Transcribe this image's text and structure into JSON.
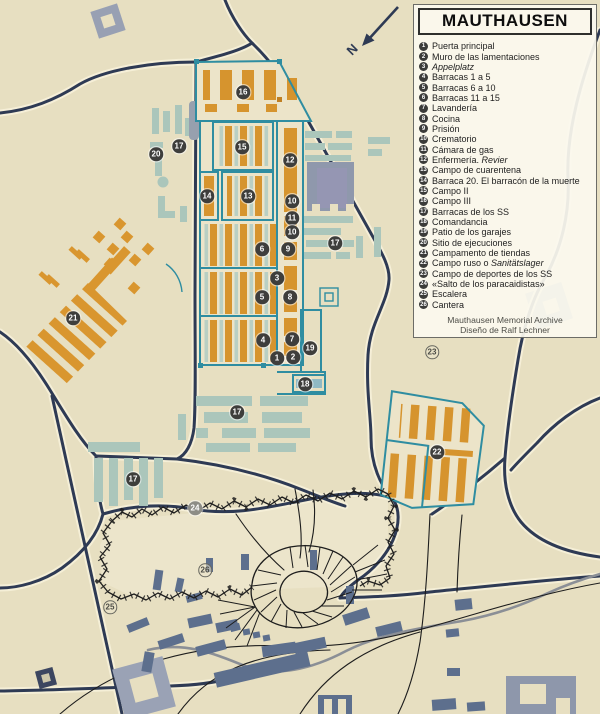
{
  "map": {
    "north_label": "N",
    "colors": {
      "background": "#e7dfc1",
      "road": "#2e3a54",
      "camp_outline": "#2f8da1",
      "barracks_orange": "#d6942e",
      "building_teal": "#abc6bb",
      "building_gray": "#5d6f8d"
    },
    "markers": [
      {
        "n": "1",
        "x": 277,
        "y": 358,
        "s": "dark"
      },
      {
        "n": "2",
        "x": 293,
        "y": 357,
        "s": "dark"
      },
      {
        "n": "3",
        "x": 277,
        "y": 278,
        "s": "dark"
      },
      {
        "n": "4",
        "x": 263,
        "y": 340,
        "s": "dark"
      },
      {
        "n": "5",
        "x": 262,
        "y": 297,
        "s": "dark"
      },
      {
        "n": "6",
        "x": 262,
        "y": 249,
        "s": "dark"
      },
      {
        "n": "7",
        "x": 292,
        "y": 339,
        "s": "dark"
      },
      {
        "n": "8",
        "x": 290,
        "y": 297,
        "s": "dark"
      },
      {
        "n": "9",
        "x": 288,
        "y": 249,
        "s": "dark"
      },
      {
        "n": "10",
        "x": 292,
        "y": 201,
        "s": "dark"
      },
      {
        "n": "11",
        "x": 292,
        "y": 218,
        "s": "dark"
      },
      {
        "n": "10",
        "x": 292,
        "y": 232,
        "s": "dark"
      },
      {
        "n": "12",
        "x": 290,
        "y": 160,
        "s": "dark"
      },
      {
        "n": "13",
        "x": 248,
        "y": 196,
        "s": "dark"
      },
      {
        "n": "14",
        "x": 207,
        "y": 196,
        "s": "dark"
      },
      {
        "n": "15",
        "x": 242,
        "y": 147,
        "s": "dark"
      },
      {
        "n": "16",
        "x": 243,
        "y": 92,
        "s": "dark"
      },
      {
        "n": "17",
        "x": 179,
        "y": 146,
        "s": "dark"
      },
      {
        "n": "17",
        "x": 335,
        "y": 243,
        "s": "dark"
      },
      {
        "n": "17",
        "x": 237,
        "y": 412,
        "s": "dark"
      },
      {
        "n": "17",
        "x": 133,
        "y": 479,
        "s": "dark"
      },
      {
        "n": "18",
        "x": 305,
        "y": 384,
        "s": "dark"
      },
      {
        "n": "19",
        "x": 310,
        "y": 348,
        "s": "dark"
      },
      {
        "n": "20",
        "x": 156,
        "y": 154,
        "s": "dark"
      },
      {
        "n": "21",
        "x": 73,
        "y": 318,
        "s": "dark"
      },
      {
        "n": "22",
        "x": 437,
        "y": 452,
        "s": "dark"
      },
      {
        "n": "23",
        "x": 432,
        "y": 352,
        "s": "light"
      },
      {
        "n": "24",
        "x": 195,
        "y": 508,
        "s": "gray"
      },
      {
        "n": "25",
        "x": 110,
        "y": 607,
        "s": "light"
      },
      {
        "n": "26",
        "x": 205,
        "y": 570,
        "s": "light"
      }
    ]
  },
  "legend": {
    "title": "MAUTHAUSEN",
    "items": [
      {
        "n": "1",
        "parts": [
          {
            "t": "Puerta principal"
          }
        ]
      },
      {
        "n": "2",
        "parts": [
          {
            "t": "Muro de las lamentaciones"
          }
        ]
      },
      {
        "n": "3",
        "parts": [
          {
            "t": "Appelplatz",
            "i": true
          }
        ]
      },
      {
        "n": "4",
        "parts": [
          {
            "t": "Barracas 1 a 5"
          }
        ]
      },
      {
        "n": "5",
        "parts": [
          {
            "t": "Barracas 6 a 10"
          }
        ]
      },
      {
        "n": "6",
        "parts": [
          {
            "t": "Barracas 11 a 15"
          }
        ]
      },
      {
        "n": "7",
        "parts": [
          {
            "t": "Lavandería"
          }
        ]
      },
      {
        "n": "8",
        "parts": [
          {
            "t": "Cocina"
          }
        ]
      },
      {
        "n": "9",
        "parts": [
          {
            "t": "Prisión"
          }
        ]
      },
      {
        "n": "10",
        "parts": [
          {
            "t": "Crematorio"
          }
        ]
      },
      {
        "n": "11",
        "parts": [
          {
            "t": "Cámara de gas"
          }
        ]
      },
      {
        "n": "12",
        "parts": [
          {
            "t": "Enfermería. "
          },
          {
            "t": "Revier",
            "i": true
          }
        ]
      },
      {
        "n": "13",
        "parts": [
          {
            "t": "Campo de cuarentena"
          }
        ]
      },
      {
        "n": "14",
        "parts": [
          {
            "t": "Barraca 20. El barracón de la muerte"
          }
        ]
      },
      {
        "n": "15",
        "parts": [
          {
            "t": "Campo II"
          }
        ]
      },
      {
        "n": "16",
        "parts": [
          {
            "t": "Campo III"
          }
        ]
      },
      {
        "n": "17",
        "parts": [
          {
            "t": "Barracas de los SS"
          }
        ]
      },
      {
        "n": "18",
        "parts": [
          {
            "t": "Comandancia"
          }
        ]
      },
      {
        "n": "19",
        "parts": [
          {
            "t": "Patio de los garajes"
          }
        ]
      },
      {
        "n": "20",
        "parts": [
          {
            "t": "Sitio de ejecuciones"
          }
        ]
      },
      {
        "n": "21",
        "parts": [
          {
            "t": "Campamento de tiendas"
          }
        ]
      },
      {
        "n": "22",
        "parts": [
          {
            "t": "Campo ruso o "
          },
          {
            "t": "Sanitätslager",
            "i": true
          }
        ]
      },
      {
        "n": "23",
        "parts": [
          {
            "t": "Campo de deportes de los SS"
          }
        ]
      },
      {
        "n": "24",
        "parts": [
          {
            "t": "«Salto de los paracaidistas»"
          }
        ]
      },
      {
        "n": "25",
        "parts": [
          {
            "t": "Escalera"
          }
        ]
      },
      {
        "n": "26",
        "parts": [
          {
            "t": "Cantera"
          }
        ]
      }
    ],
    "footer_line1": "Mauthausen Memorial Archive",
    "footer_line2": "Diseño de Ralf Lechner"
  }
}
